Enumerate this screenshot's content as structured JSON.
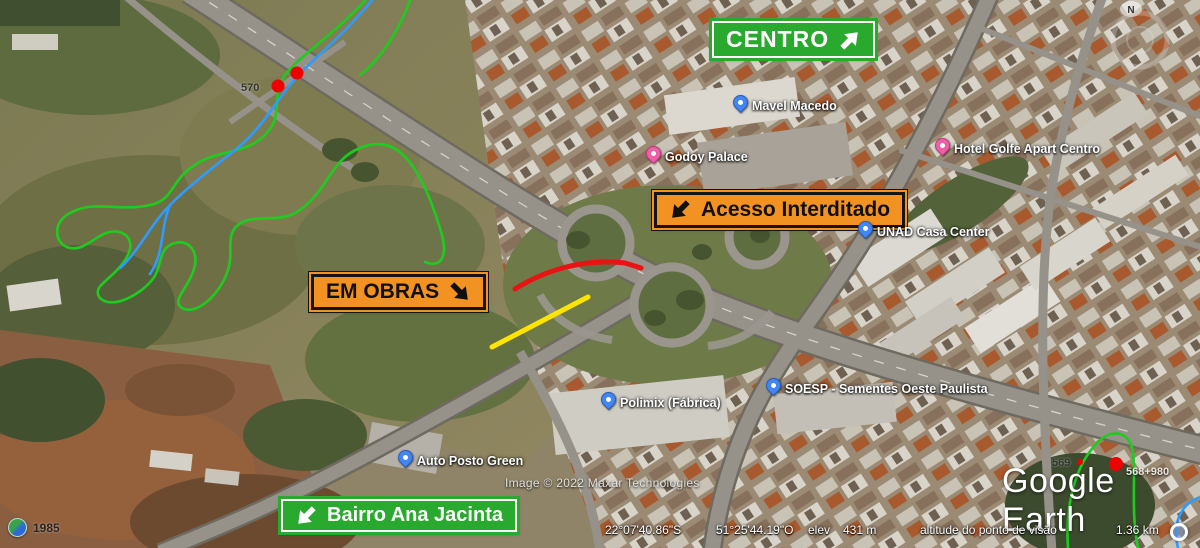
{
  "signs": [
    {
      "id": "centro",
      "label": "CENTRO",
      "arrow": "ne"
    },
    {
      "id": "acesso-interditado",
      "label": "Acesso Interditado",
      "arrow": "sw"
    },
    {
      "id": "em-obras",
      "label": "EM OBRAS",
      "arrow": "se"
    },
    {
      "id": "bairro-ana-jacinta",
      "label": "Bairro Ana Jacinta",
      "arrow": "sw"
    }
  ],
  "places": [
    {
      "name": "Mavel Macedo",
      "pin": "blue"
    },
    {
      "name": "Godoy Palace",
      "pin": "pink"
    },
    {
      "name": "Hotel Golfe Apart Centro",
      "pin": "pink"
    },
    {
      "name": "UNAD Casa Center",
      "pin": "blue"
    },
    {
      "name": "SOESP - Sementes Oeste Paulista",
      "pin": "blue"
    },
    {
      "name": "Polimix (Fábrica)",
      "pin": "blue"
    },
    {
      "name": "Auto Posto Green",
      "pin": "blue"
    }
  ],
  "km_markers": [
    {
      "label": "570"
    },
    {
      "label": "569"
    },
    {
      "label": "568+980"
    }
  ],
  "attribution": "Image © 2022 Maxar Technologies",
  "branding": {
    "logo": "Google Earth"
  },
  "status_bar": {
    "lat": "22°07'40.86\"S",
    "lon": "51°25'44.19\"O",
    "elev_label": "elev",
    "elev_value": "431 m",
    "altitude_label": "altitude do ponto de visão",
    "altitude_value": "1.36 km"
  },
  "timeline": {
    "year": "1985"
  },
  "compass": {
    "north": "N"
  },
  "colors": {
    "sign_green": "#2aa92f",
    "sign_orange": "#f29222",
    "overlay_green": "#1ecc1e",
    "overlay_blue": "#2e9bff",
    "overlay_red": "#e81313",
    "overlay_yellow": "#ffe400",
    "marker_red": "#ee0000"
  }
}
